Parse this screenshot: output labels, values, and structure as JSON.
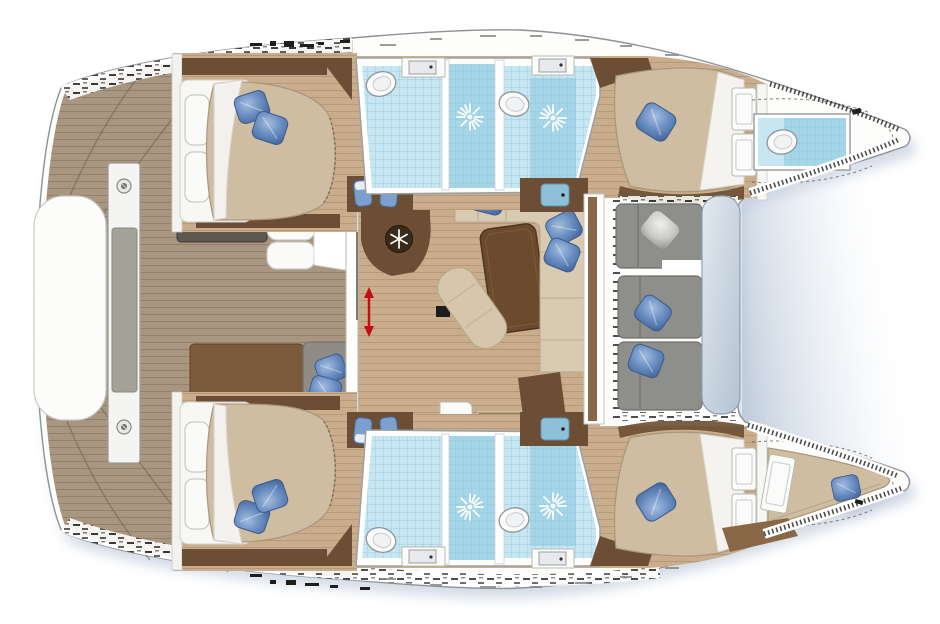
{
  "meta": {
    "diagram_kind": "yacht interior floor plan",
    "vessel_type": "sailing catamaran (twin hulls)",
    "orientation": "bows pointing right, aft deck at left",
    "visible_text": "none"
  },
  "palette": {
    "hull_white": "#fdfdfc",
    "hull_outline": "#8e9296",
    "shadow_blue": "#b0bfd2",
    "deck_wood": "#a89681",
    "deck_plank_line": "#93816b",
    "deck_seam": "#6f5f4e",
    "cabin_wood": "#c9ad8c",
    "cabin_plank_line": "#ae916f",
    "dark_wood": "#6b4e33",
    "mid_wood": "#8a6847",
    "step_wood": "#9c7a54",
    "duvet_beige": "#cfbda2",
    "duvet_shadow": "#a8977c",
    "mattress_white": "#f7f7f5",
    "pillow_blue": "#6a8ec2",
    "pillow_blue_dark": "#47699f",
    "pillow_silver": "#c9c9c5",
    "tile_blue": "#a5d6e8",
    "tile_blue_light": "#c6e6f2",
    "tile_grid": "#8fc6dc",
    "fixture_white": "#fbfbfa",
    "wall_gray": "#9aa0a4",
    "sofa_cream": "#d9cbb2",
    "sofa_gray": "#8e8e8a",
    "sofa_gray_seam": "#70706c",
    "cockpit_table": "#b3c2d2",
    "bench_brown": "#7b5b3b",
    "bench_gray": "#5d594f",
    "berth_gray": "#8e8c84",
    "cushion_white": "#fafaf8",
    "arrow_red": "#c01010",
    "sink_blue": "#8fc0da",
    "seat_blue": "#7d9fce"
  },
  "rooms": [
    {
      "id": "aft-deck",
      "label": "aft deck",
      "features": [
        "teak planking",
        "arch beam with cushion",
        "white lounge pad",
        "bench seats",
        "day berth with blue pillows"
      ]
    },
    {
      "id": "salon",
      "label": "salon",
      "features": [
        "wood sole",
        "cream L-sofa with 3 blue pillows",
        "coffee table",
        "chaise pad",
        "sliding aft door with red arrow",
        "two staircases to hulls"
      ]
    },
    {
      "id": "galley",
      "label": "galley",
      "features": [
        "curved counter",
        "refrigerator (snowflake icon)",
        "sink counters with blue basins"
      ]
    },
    {
      "id": "forward-cockpit",
      "label": "forward cockpit",
      "features": [
        "gray modular sofa",
        "silver pillow",
        "2 blue pillows",
        "pale blue lounge table pad"
      ]
    },
    {
      "id": "port-aft-cabin",
      "label": "port aft cabin",
      "features": [
        "double bed",
        "2 blue pillows",
        "vanity with 2 blue stools"
      ]
    },
    {
      "id": "port-bathroom-aft",
      "label": "port aft bathroom",
      "features": [
        "toilet",
        "sink",
        "shower with sunburst rose"
      ]
    },
    {
      "id": "port-bathroom-forward",
      "label": "port forward bathroom",
      "features": [
        "toilet",
        "sink",
        "shower with sunburst rose"
      ]
    },
    {
      "id": "port-forward-cabin",
      "label": "port forward cabin",
      "features": [
        "double bed",
        "blue pillow",
        "bulkhead door"
      ]
    },
    {
      "id": "port-bow-wc",
      "label": "port bow WC",
      "features": [
        "toilet",
        "blue tiled sole"
      ]
    },
    {
      "id": "starboard-aft-cabin",
      "label": "starboard aft cabin",
      "features": [
        "double bed",
        "2 blue pillows",
        "vanity with 2 blue stools"
      ]
    },
    {
      "id": "starboard-bathroom-aft",
      "label": "starboard aft bathroom",
      "features": [
        "toilet",
        "sink",
        "shower with sunburst rose"
      ]
    },
    {
      "id": "starboard-bathroom-forward",
      "label": "starboard forward bathroom",
      "features": [
        "toilet",
        "sink",
        "shower with sunburst rose"
      ]
    },
    {
      "id": "starboard-forward-cabin",
      "label": "starboard forward cabin",
      "features": [
        "double bed",
        "blue pillow",
        "bulkhead door"
      ]
    },
    {
      "id": "starboard-bow-cabin",
      "label": "starboard bow berth",
      "features": [
        "wedge berth",
        "blue pillow",
        "doors"
      ]
    }
  ],
  "icons": [
    {
      "name": "snowflake-icon",
      "meaning": "refrigerator / freezer"
    },
    {
      "name": "shower-sunburst-icon",
      "meaning": "shower rose"
    },
    {
      "name": "sliding-door-arrow-icon",
      "meaning": "sliding door travel direction"
    },
    {
      "name": "bolt-icon",
      "meaning": "deck fitting"
    },
    {
      "name": "cleat-marks",
      "meaning": "deck hardware"
    }
  ],
  "inventory": {
    "double_beds": 4,
    "bow_berths": 1,
    "toilets": 5,
    "showers": 4,
    "sinks": 4,
    "blue_pillows": 14,
    "silver_pillows": 1,
    "vanity_stools": 4,
    "staircases": 2
  }
}
